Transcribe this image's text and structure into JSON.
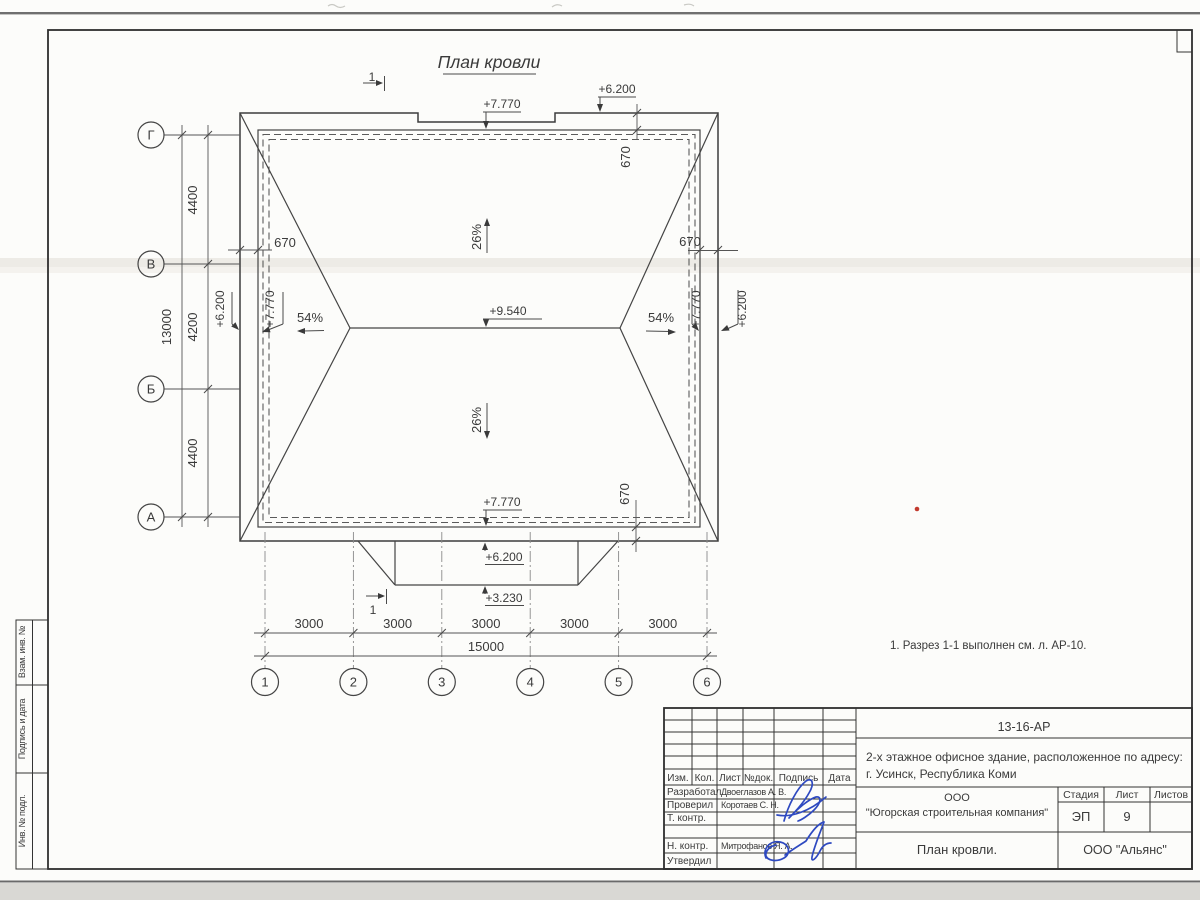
{
  "plan": {
    "title": "План кровли",
    "note": "1. Разрез 1-1 выполнен см. л. АР-10.",
    "section_mark": "1",
    "slope_main": "26%",
    "slope_end": "54%",
    "overhang": "670",
    "elev_ridge": "+9.540",
    "elev_parapet": "+7.770",
    "elev_eave": "+6.200",
    "elev_porch": "+3.230",
    "axes_left": [
      "Г",
      "В",
      "Б",
      "А"
    ],
    "axes_bottom": [
      "1",
      "2",
      "3",
      "4",
      "5",
      "6"
    ],
    "dims_left": [
      "4400",
      "4200",
      "4400"
    ],
    "dim_left_total": "13000",
    "dims_bottom": [
      "3000",
      "3000",
      "3000",
      "3000",
      "3000"
    ],
    "dim_bottom_total": "15000"
  },
  "titleblock": {
    "doc_number": "13-16-АР",
    "project_line1": "2-х этажное офисное здание, расположенное по адресу:",
    "project_line2": "г. Усинск, Республика Коми",
    "change_header": [
      "Изм.",
      "Кол.",
      "Лист",
      "№док.",
      "Подпись",
      "Дата"
    ],
    "role_developed": "Разработал",
    "role_checked": "Проверил",
    "role_tcontrol": "Т. контр.",
    "role_ncontrol": "Н. контр.",
    "role_approved": "Утвердил",
    "name_developed": "Двоеглазов А. В.",
    "name_checked": "Коротаев С. Н.",
    "name_ncontrol": "Митрофанов Я. А.",
    "company_line1": "ООО",
    "company_line2": "\"Югорская строительная компания\"",
    "stage_label": "Стадия",
    "sheet_label": "Лист",
    "sheets_label": "Листов",
    "stage_value": "ЭП",
    "sheet_value": "9",
    "sheet_title": "План кровли.",
    "org": "ООО \"Альянс\""
  },
  "strip": {
    "labels": [
      "Взам. инв. №",
      "Подпись и дата",
      "Инв. № подл."
    ]
  },
  "colors": {
    "ink_blue": "#2e49c0",
    "line_dark": "#3d3d3d",
    "red_mark": "#c23a2e"
  }
}
